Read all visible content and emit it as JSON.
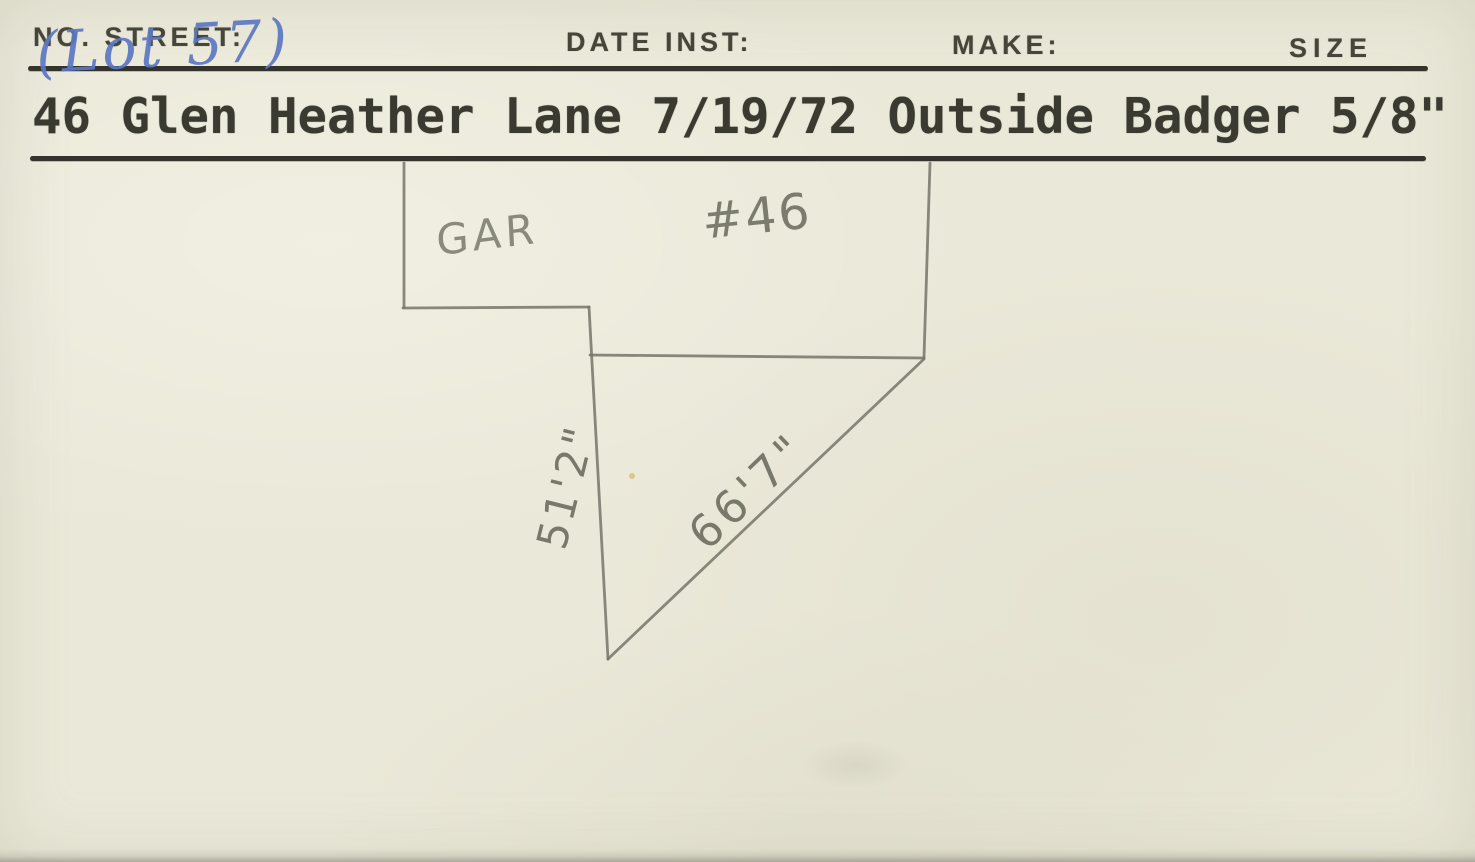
{
  "card": {
    "colors": {
      "background": "#eae8d8",
      "print_ink": "#45453a",
      "rule": "#34342c",
      "typewriter_ink": "#3a3a30",
      "pencil": "#74746a",
      "pen_blue": "#5b78c2"
    },
    "header": {
      "no_street_label": "NO. STREET:",
      "date_inst_label": "DATE INST:",
      "make_label": "MAKE:",
      "size_label": "SIZE"
    },
    "handwritten": {
      "lot_annotation": "(Lot 57)"
    },
    "typed_line": "46 Glen Heather Lane 7/19/72 Outside Badger 5/8\"",
    "record": {
      "no_street": "46 Glen Heather Lane",
      "date_inst": "7/19/72",
      "location": "Outside",
      "make": "Badger",
      "size": "5/8\""
    },
    "diagram": {
      "garage_label": "GAR",
      "house_label": "#46",
      "left_dimension": "51'2\"",
      "diagonal_dimension": "66'7\""
    }
  }
}
